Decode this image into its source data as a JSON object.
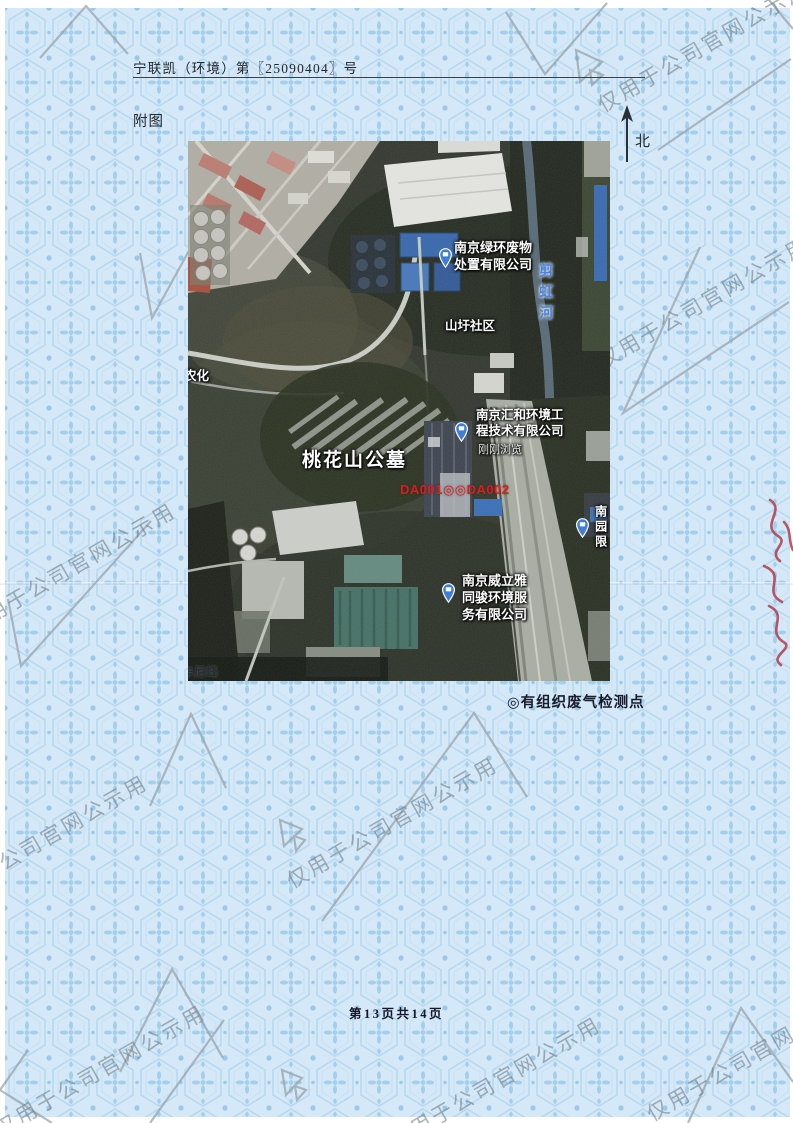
{
  "document": {
    "doc_number": "宁联凯（环境）第〖25090404〗号",
    "figure_label": "附图",
    "north_label": "北",
    "legend_text": "◎有组织废气检测点",
    "page_footer": "第13页共14页",
    "watermark_text": "仅用于公司官网公示用"
  },
  "map": {
    "labels": {
      "green_ring_l1": "南京绿环废物",
      "green_ring_l2": "处置有限公司",
      "river": "剪虹河",
      "community": "山圩社区",
      "huihe_l1": "南京汇和环境工",
      "huihe_l2": "程技术有限公司",
      "huihe_note": "刚刚浏览",
      "monitoring_points": "DA001◎◎DA002",
      "cemetery": "桃花山公墓",
      "veolia_l1": "南京威立雅",
      "veolia_l2": "同骏环境服",
      "veolia_l3": "务有限公司",
      "clipped_company": "南园限",
      "agrochem": "农化",
      "peak": "牟尼峰"
    },
    "colors": {
      "pin_blue": "#3f7ed4",
      "river_label": "#4d82d8",
      "monitoring_red": "#d42020",
      "legend_ink": "#171b2b"
    }
  }
}
